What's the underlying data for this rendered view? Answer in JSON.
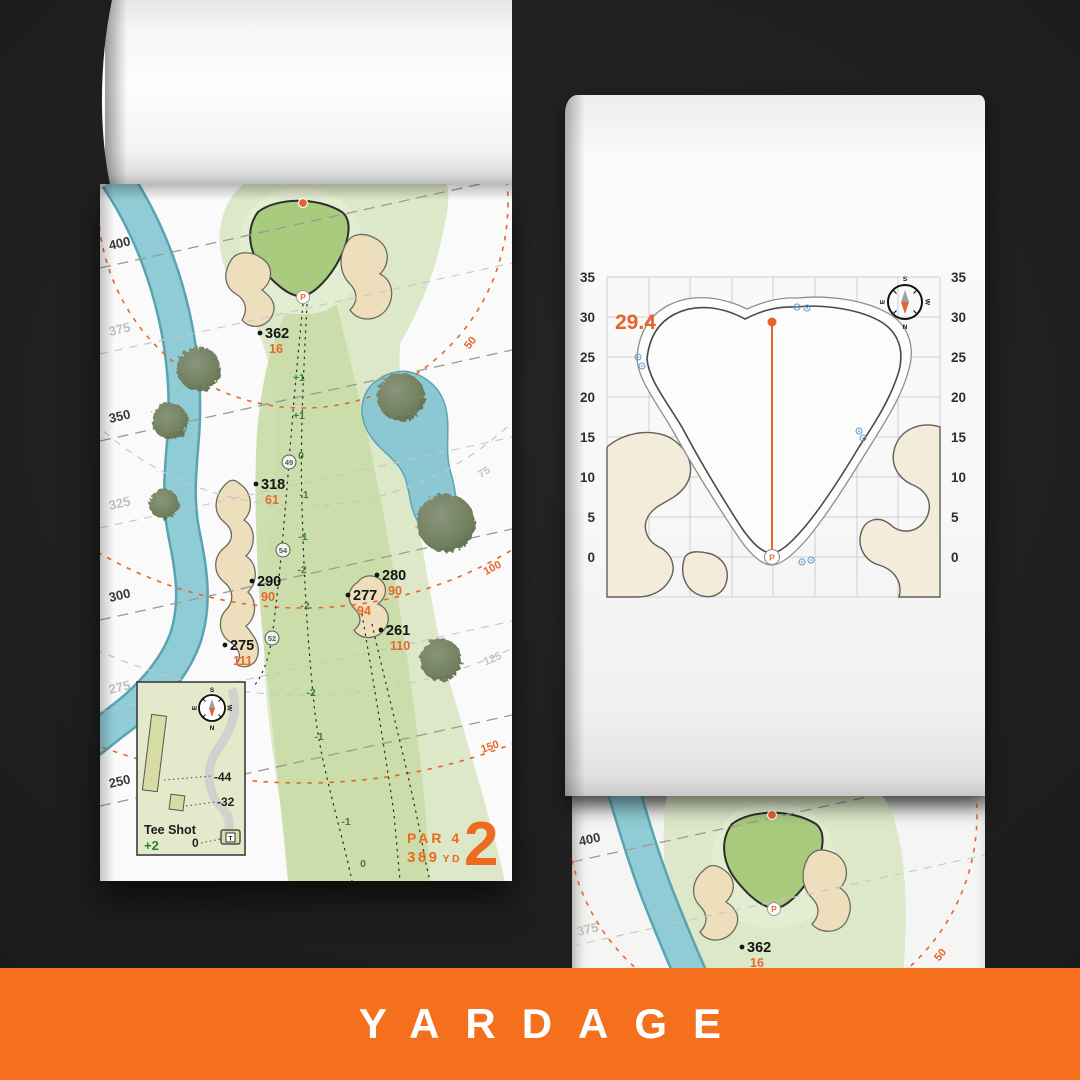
{
  "banner": {
    "title": "YARDAGE",
    "bg_color": "#f4701d"
  },
  "palette": {
    "accent_orange": "#ed6a1f",
    "banner_orange": "#f4701d",
    "elevation_green": "#3e7f3e",
    "water_blue": "#8fcbd4",
    "sand_beige": "#eddfbc",
    "fairway_green": "#c8dca6",
    "green_surface": "#a9cb7e"
  },
  "compass": {
    "n": "N",
    "s": "S",
    "e": "E",
    "w": "W"
  },
  "hole_map": {
    "yard_lines": [
      "400",
      "375",
      "350",
      "325",
      "300",
      "275",
      "250"
    ],
    "arc_labels": [
      "50",
      "75",
      "100",
      "125",
      "150"
    ],
    "markers": [
      {
        "dist": "362",
        "carry": "16"
      },
      {
        "dist": "318",
        "carry": "61"
      },
      {
        "dist": "290",
        "carry": "90"
      },
      {
        "dist": "280",
        "carry": "90"
      },
      {
        "dist": "277",
        "carry": "94"
      },
      {
        "dist": "261",
        "carry": "110"
      },
      {
        "dist": "275",
        "carry": "111"
      }
    ],
    "elevations": [
      "+1",
      "+1",
      "0",
      "-1",
      "-1",
      "-2",
      "-2",
      "-2",
      "-1",
      "-1",
      "0"
    ],
    "circled": [
      "49",
      "54",
      "52"
    ],
    "pin_letter": "P",
    "inset": {
      "title": "Tee Shot",
      "score": "+2",
      "len_long": "-44",
      "len_short": "-32",
      "zero": "0",
      "tee_letter": "T"
    },
    "par_label": "PAR 4",
    "yardage_number": "389",
    "yardage_unit": "YD",
    "hole_number": "2"
  },
  "green_page": {
    "pin_distance": "29.4",
    "ticks": [
      "35",
      "30",
      "25",
      "20",
      "15",
      "10",
      "5",
      "0"
    ],
    "pin_letter": "P"
  },
  "next_page": {
    "yard_lines": [
      "400",
      "375"
    ],
    "marker": {
      "dist": "362",
      "carry": "16"
    },
    "arc_label": "50",
    "pin_letter": "P"
  }
}
